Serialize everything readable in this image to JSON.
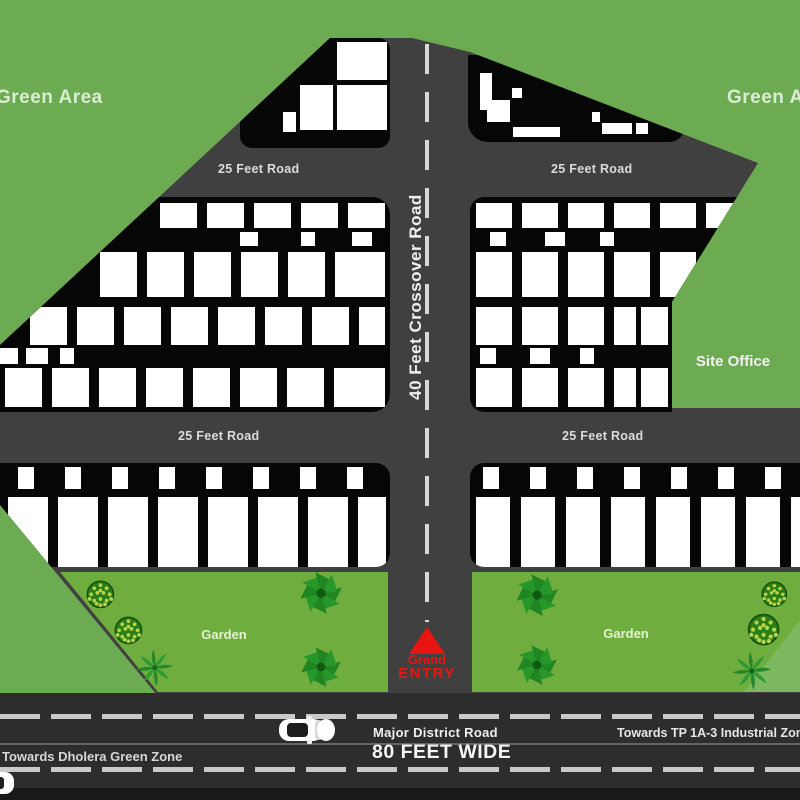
{
  "labels": {
    "green_area_left": "Green Area",
    "green_area_right": "Green Area",
    "site_office": "Site Office",
    "garden": "Garden",
    "crossover_road": "40 Feet Crossover Road",
    "road_25": "25 Feet Road",
    "grand_entry_line1": "Grand",
    "grand_entry_line2": "ENTRY",
    "towards_left": "Towards Dholera Green Zone",
    "major_road": "Major District Road",
    "road_width": "80 FEET WIDE",
    "towards_right": "Towards TP 1A-3  Industrial Zone>"
  },
  "colors": {
    "bg_green": "#6dab52",
    "site_gray": "#404040",
    "block_black": "#060606",
    "garden_green": "#6fae3e",
    "wedge_green": "#7cb85f",
    "road_dark": "#2d2d2d",
    "road_strip": "#191919",
    "red": "#e81410",
    "dash": "#d8d8d8",
    "lane": "#c9c9c9"
  },
  "plot_blocks": [
    {
      "name": "block-top-left",
      "x": 240,
      "y": 38,
      "w": 150,
      "h": 110,
      "r": "12px",
      "rows": [
        {
          "y": 42,
          "h": 38,
          "cells": [
            [
              337,
              50
            ]
          ]
        },
        {
          "y": 85,
          "h": 45,
          "cells": [
            [
              300,
              33
            ],
            [
              337,
              50
            ]
          ]
        },
        {
          "y": 112,
          "h": 20,
          "cells": [
            [
              283,
              13
            ]
          ]
        }
      ]
    },
    {
      "name": "block-top-right",
      "x": 468,
      "y": 55,
      "w": 216,
      "h": 87,
      "r": "0 0 14px 20px",
      "rows": [
        {
          "y": 73,
          "h": 37,
          "cells": [
            [
              480,
              12
            ]
          ]
        },
        {
          "y": 88,
          "h": 10,
          "cells": [
            [
              512,
              10
            ]
          ]
        },
        {
          "y": 100,
          "h": 22,
          "cells": [
            [
              487,
              23
            ]
          ]
        },
        {
          "y": 112,
          "h": 10,
          "cells": [
            [
              592,
              8
            ]
          ]
        },
        {
          "y": 123,
          "h": 11,
          "cells": [
            [
              602,
              30
            ],
            [
              636,
              12
            ]
          ]
        },
        {
          "y": 127,
          "h": 10,
          "cells": [
            [
              513,
              47
            ]
          ]
        }
      ]
    },
    {
      "name": "block-mid-left",
      "x": 0,
      "y": 197,
      "w": 390,
      "h": 215,
      "r": "0 18px 18px 0",
      "rows": [
        {
          "y": 203,
          "h": 25,
          "cells": [
            [
              160,
              37
            ],
            [
              207,
              37
            ],
            [
              254,
              37
            ],
            [
              301,
              37
            ],
            [
              348,
              37
            ]
          ]
        },
        {
          "y": 232,
          "h": 14,
          "cells": [
            [
              240,
              18
            ],
            [
              301,
              14
            ],
            [
              352,
              20
            ]
          ]
        },
        {
          "y": 252,
          "h": 45,
          "cells": [
            [
              100,
              37
            ],
            [
              147,
              37
            ],
            [
              194,
              37
            ],
            [
              241,
              37
            ],
            [
              288,
              37
            ],
            [
              335,
              50
            ]
          ]
        },
        {
          "y": 307,
          "h": 38,
          "cells": [
            [
              30,
              37
            ],
            [
              77,
              37
            ],
            [
              124,
              37
            ],
            [
              171,
              37
            ],
            [
              218,
              37
            ],
            [
              265,
              37
            ],
            [
              312,
              37
            ],
            [
              359,
              26
            ]
          ]
        },
        {
          "y": 348,
          "h": 16,
          "cells": [
            [
              0,
              18
            ],
            [
              26,
              22
            ],
            [
              60,
              14
            ]
          ]
        },
        {
          "y": 368,
          "h": 39,
          "cells": [
            [
              5,
              37
            ],
            [
              52,
              37
            ],
            [
              99,
              37
            ],
            [
              146,
              37
            ],
            [
              193,
              37
            ],
            [
              240,
              37
            ],
            [
              287,
              37
            ],
            [
              334,
              51
            ]
          ]
        }
      ]
    },
    {
      "name": "block-mid-right",
      "x": 470,
      "y": 197,
      "w": 288,
      "h": 215,
      "r": "14px",
      "clip": "polygon(0px 0px, 267px 0px, 202px 105px, 202px 215px, 0px 215px)",
      "rows": [
        {
          "y": 203,
          "h": 25,
          "cells": [
            [
              476,
              36
            ],
            [
              522,
              36
            ],
            [
              568,
              36
            ],
            [
              614,
              36
            ],
            [
              660,
              36
            ],
            [
              706,
              28
            ]
          ]
        },
        {
          "y": 232,
          "h": 14,
          "cells": [
            [
              490,
              16
            ],
            [
              545,
              20
            ],
            [
              600,
              14
            ]
          ]
        },
        {
          "y": 252,
          "h": 45,
          "cells": [
            [
              476,
              36
            ],
            [
              522,
              36
            ],
            [
              568,
              36
            ],
            [
              614,
              36
            ],
            [
              660,
              36
            ]
          ]
        },
        {
          "y": 307,
          "h": 38,
          "cells": [
            [
              476,
              36
            ],
            [
              522,
              36
            ],
            [
              568,
              36
            ],
            [
              614,
              22
            ],
            [
              641,
              27
            ]
          ]
        },
        {
          "y": 348,
          "h": 16,
          "cells": [
            [
              480,
              16
            ],
            [
              530,
              20
            ],
            [
              580,
              14
            ]
          ]
        },
        {
          "y": 368,
          "h": 39,
          "cells": [
            [
              476,
              36
            ],
            [
              522,
              36
            ],
            [
              568,
              36
            ],
            [
              614,
              22
            ],
            [
              641,
              27
            ]
          ]
        }
      ]
    },
    {
      "name": "block-bottom-left",
      "x": 0,
      "y": 463,
      "w": 390,
      "h": 104,
      "r": "0 14px 14px 0",
      "rows": [
        {
          "y": 467,
          "h": 22,
          "cells": [
            [
              18,
              16
            ],
            [
              65,
              16
            ],
            [
              112,
              16
            ],
            [
              159,
              16
            ],
            [
              206,
              16
            ],
            [
              253,
              16
            ],
            [
              300,
              16
            ],
            [
              347,
              16
            ]
          ]
        },
        {
          "y": 497,
          "h": 70,
          "cells": [
            [
              8,
              40
            ],
            [
              58,
              40
            ],
            [
              108,
              40
            ],
            [
              158,
              40
            ],
            [
              208,
              40
            ],
            [
              258,
              40
            ],
            [
              308,
              40
            ],
            [
              358,
              28
            ]
          ]
        }
      ]
    },
    {
      "name": "block-bottom-right",
      "x": 470,
      "y": 463,
      "w": 330,
      "h": 104,
      "r": "14px 0 0 14px",
      "rows": [
        {
          "y": 467,
          "h": 22,
          "cells": [
            [
              483,
              16
            ],
            [
              530,
              16
            ],
            [
              577,
              16
            ],
            [
              624,
              16
            ],
            [
              671,
              16
            ],
            [
              718,
              16
            ],
            [
              765,
              16
            ]
          ]
        },
        {
          "y": 497,
          "h": 70,
          "cells": [
            [
              476,
              34
            ],
            [
              521,
              34
            ],
            [
              566,
              34
            ],
            [
              611,
              34
            ],
            [
              656,
              34
            ],
            [
              701,
              34
            ],
            [
              746,
              34
            ],
            [
              791,
              14
            ]
          ]
        }
      ]
    }
  ],
  "trees": [
    {
      "type": "dotted",
      "x": 100,
      "y": 594,
      "r": 14
    },
    {
      "type": "dotted",
      "x": 128,
      "y": 630,
      "r": 14
    },
    {
      "type": "palm",
      "x": 155,
      "y": 668,
      "r": 17
    },
    {
      "type": "pinwheel",
      "x": 321,
      "y": 593,
      "r": 21
    },
    {
      "type": "pinwheel",
      "x": 321,
      "y": 667,
      "r": 20
    },
    {
      "type": "pinwheel",
      "x": 537,
      "y": 595,
      "r": 21
    },
    {
      "type": "pinwheel",
      "x": 537,
      "y": 665,
      "r": 20
    },
    {
      "type": "dotted",
      "x": 774,
      "y": 594,
      "r": 13
    },
    {
      "type": "dotted",
      "x": 764,
      "y": 630,
      "r": 16
    },
    {
      "type": "palm",
      "x": 752,
      "y": 671,
      "r": 18
    }
  ]
}
